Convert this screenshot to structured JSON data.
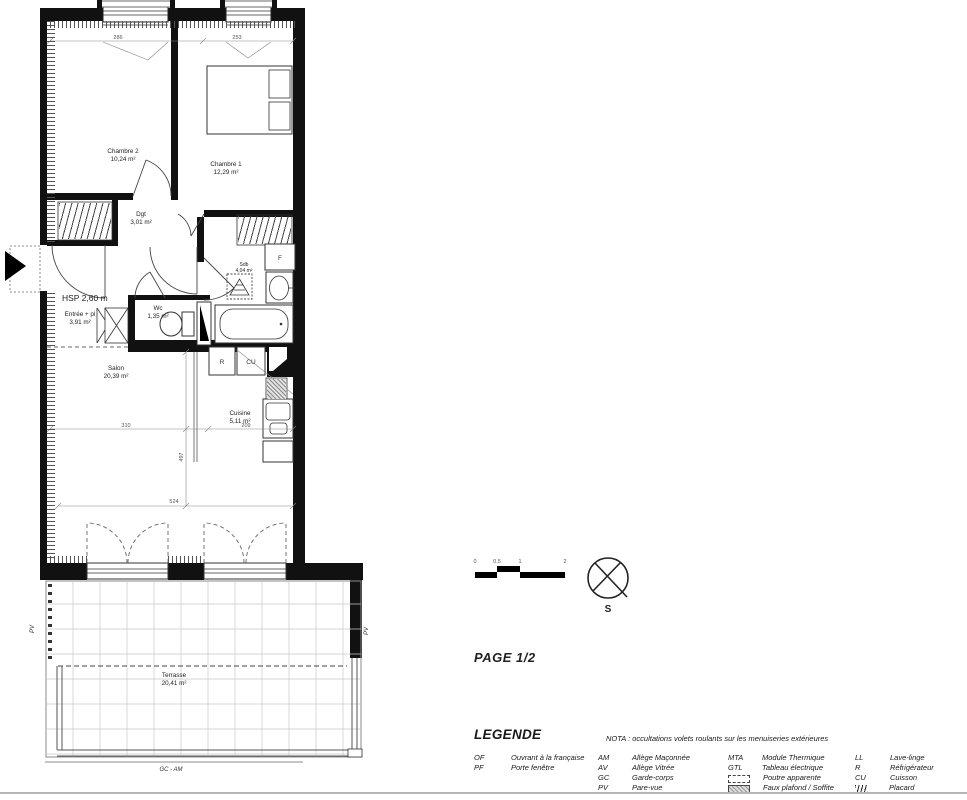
{
  "page": {
    "label": "PAGE 1/2"
  },
  "plan": {
    "ceiling_height": "HSP 2,60 m",
    "rooms": [
      {
        "name": "Chambre 2",
        "area": "10,24 m²"
      },
      {
        "name": "Chambre 1",
        "area": "12,29 m²"
      },
      {
        "name": "Dgt",
        "area": "3,01 m²"
      },
      {
        "name": "Sdb",
        "area": "4,04 m²"
      },
      {
        "name": "Wc",
        "area": "1,35 m²"
      },
      {
        "name": "Entrée + pl",
        "area": "3,91 m²"
      },
      {
        "name": "Salon",
        "area": "20,39 m²"
      },
      {
        "name": "Cuisine",
        "area": "5,11 m²"
      },
      {
        "name": "Terrasse",
        "area": "20,41 m²"
      }
    ],
    "dimensions": {
      "window_left": "286",
      "window_right": "253",
      "salon_width": "310",
      "cuisine_width": "209",
      "depth": "497",
      "overall_width": "524"
    },
    "labels": {
      "fridge": "R",
      "cooking": "CU",
      "f": "F",
      "pare_vue": "PV",
      "railing": "GC - AM"
    },
    "icons": {
      "entrance_arrow": "filled-right-triangle",
      "compass": "crossed-circle-north-indicator"
    }
  },
  "scale_bar": {
    "ticks": [
      "0",
      "0.5",
      "1",
      "2"
    ]
  },
  "compass": {
    "south": "S"
  },
  "legend": {
    "title": "LEGENDE",
    "nota": "NOTA : occultations volets roulants sur les menuiseries extérieures",
    "col1": [
      {
        "abbr": "OF",
        "label": "Ouvrant à la française"
      },
      {
        "abbr": "PF",
        "label": "Porte fenêtre"
      }
    ],
    "col2": [
      {
        "abbr": "AM",
        "label": "Allège Maçonnée"
      },
      {
        "abbr": "AV",
        "label": "Allège Vitrée"
      },
      {
        "abbr": "GC",
        "label": "Garde-corps"
      },
      {
        "abbr": "PV",
        "label": "Pare-vue"
      }
    ],
    "col3": [
      {
        "abbr": "MTA",
        "label": "Module Thermique"
      },
      {
        "abbr": "GTL",
        "label": "Tableau électrique"
      },
      {
        "symbol": "dashed-rect",
        "label": "Poutre apparente"
      },
      {
        "symbol": "shaded-rect",
        "label": "Faux plafond / Soffite"
      }
    ],
    "col4": [
      {
        "abbr": "LL",
        "label": "Lave-linge"
      },
      {
        "abbr": "R",
        "label": "Réfrigérateur"
      },
      {
        "abbr": "CU",
        "label": "Cuisson"
      },
      {
        "symbol": "hatch",
        "label": "Placard"
      }
    ]
  }
}
